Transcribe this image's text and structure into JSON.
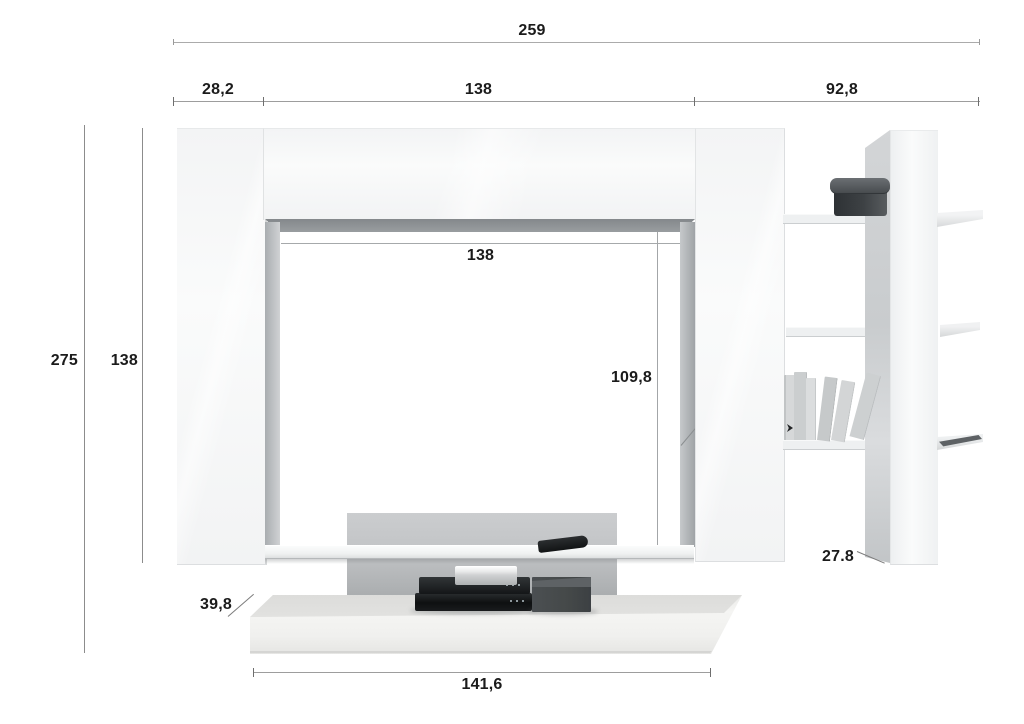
{
  "annotations": {
    "width_total": "259",
    "width_left": "28,2",
    "width_center": "138",
    "width_right": "92,8",
    "height_total": "275",
    "height_side_column": "138",
    "opening_width": "138",
    "opening_height": "109,8",
    "bookcase_depth": "27.8",
    "bench_depth": "39,8",
    "bench_width": "141,6"
  },
  "colors": {
    "background": "#ffffff",
    "dimension_line": "#9d9d9d",
    "dimension_text": "#1b1b1b",
    "furniture_white": "#f5f6f7",
    "inner_shadow": "#8f9396",
    "back_panel": "#bfc2c4",
    "decor_dark": "#35393c"
  }
}
